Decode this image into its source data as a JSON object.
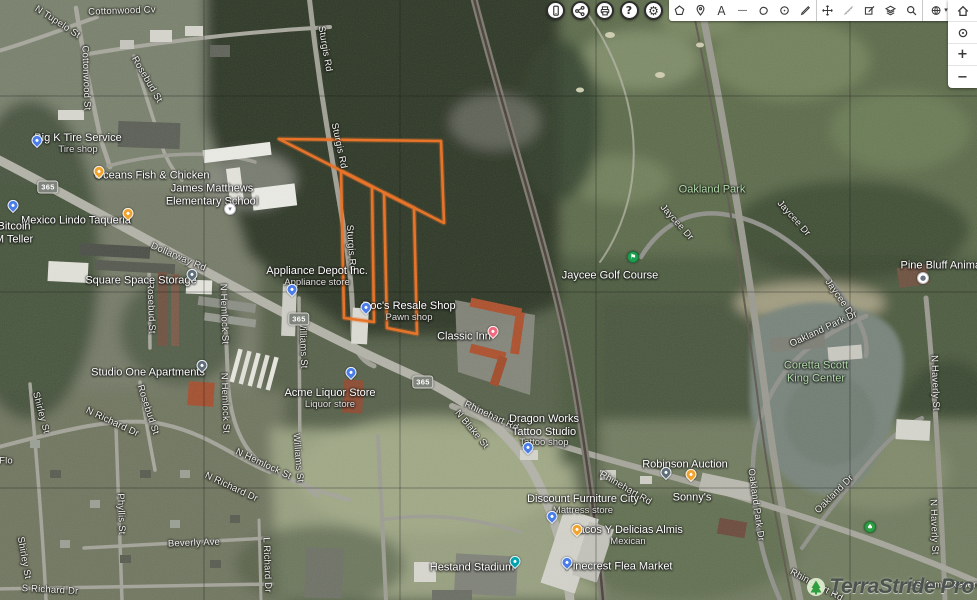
{
  "toolbar": {
    "round_buttons": [
      {
        "name": "mobile-preview"
      },
      {
        "name": "share"
      },
      {
        "name": "print"
      },
      {
        "name": "help",
        "glyph": "?"
      },
      {
        "name": "settings",
        "glyph": "⚙"
      }
    ],
    "tools": [
      {
        "name": "area-shape"
      },
      {
        "name": "add-placemark"
      },
      {
        "name": "add-text",
        "glyph": "A"
      },
      {
        "name": "draw-line",
        "glyph": "—"
      },
      {
        "name": "draw-polygon"
      },
      {
        "name": "draw-circle"
      },
      {
        "name": "draw-path"
      },
      {
        "name": "move"
      },
      {
        "name": "measure"
      },
      {
        "name": "edit-shape"
      },
      {
        "name": "layers"
      },
      {
        "name": "search"
      },
      {
        "name": "basemap",
        "caret": "▾"
      }
    ],
    "map_controls": [
      {
        "name": "home"
      },
      {
        "name": "locate"
      },
      {
        "name": "zoom-in",
        "glyph": "+"
      },
      {
        "name": "zoom-out",
        "glyph": "−"
      }
    ]
  },
  "watermark": {
    "text": "TerraStride Pro"
  },
  "map": {
    "parcel": {
      "color": "#e8742a",
      "paths": [
        "M279,139 L441,141 L444,223 Z",
        "M341,171 L344,318 L374,322 L372,187 Z",
        "M384,193 L387,328 L417,334 L414,208 Z"
      ]
    },
    "route_shields": [
      {
        "label": "365",
        "x": 48,
        "y": 187
      },
      {
        "label": "365",
        "x": 299,
        "y": 319
      },
      {
        "label": "365",
        "x": 423,
        "y": 382
      }
    ],
    "markers": [
      {
        "type": "tire-shop",
        "shape": "pin",
        "color": "#4a7de8",
        "x": 37,
        "y": 145
      },
      {
        "type": "restaurant",
        "shape": "pin",
        "color": "#f0a32e",
        "x": 99,
        "y": 176
      },
      {
        "type": "school",
        "shape": "circle",
        "color": "#ffffff",
        "glyph": "▾",
        "x": 230,
        "y": 209
      },
      {
        "type": "restaurant",
        "shape": "pin",
        "color": "#f0a32e",
        "x": 128,
        "y": 218
      },
      {
        "type": "atm",
        "shape": "pin",
        "color": "#4a7de8",
        "x": 13,
        "y": 210
      },
      {
        "type": "storage",
        "shape": "pin",
        "color": "#5f6d7a",
        "x": 192,
        "y": 279
      },
      {
        "type": "store",
        "shape": "pin",
        "color": "#4a7de8",
        "x": 292,
        "y": 294
      },
      {
        "type": "store",
        "shape": "pin",
        "color": "#4a7de8",
        "x": 366,
        "y": 312
      },
      {
        "type": "hotel",
        "shape": "pin",
        "color": "#ef6a7e",
        "x": 493,
        "y": 336
      },
      {
        "type": "apartments",
        "shape": "pin",
        "color": "#5f6d7a",
        "x": 202,
        "y": 370
      },
      {
        "type": "store",
        "shape": "pin",
        "color": "#4a7de8",
        "x": 351,
        "y": 377
      },
      {
        "type": "store",
        "shape": "pin",
        "color": "#4a7de8",
        "x": 528,
        "y": 452
      },
      {
        "type": "store",
        "shape": "pin",
        "color": "#4a7de8",
        "x": 552,
        "y": 521
      },
      {
        "type": "restaurant",
        "shape": "pin",
        "color": "#f0a32e",
        "x": 577,
        "y": 534
      },
      {
        "type": "market",
        "shape": "pin",
        "color": "#4a7de8",
        "x": 567,
        "y": 567
      },
      {
        "type": "auction",
        "shape": "pin",
        "color": "#5f6d7a",
        "x": 666,
        "y": 477
      },
      {
        "type": "restaurant",
        "shape": "pin",
        "color": "#f0a32e",
        "x": 691,
        "y": 479
      },
      {
        "type": "stadium",
        "shape": "pin",
        "color": "#00a3ad",
        "x": 515,
        "y": 566
      },
      {
        "type": "golf",
        "shape": "circle",
        "color": "#1e9e50",
        "glyph": "⚑",
        "x": 633,
        "y": 257
      },
      {
        "type": "veterinary",
        "shape": "circle",
        "color": "#ffffff",
        "glyph": "●",
        "x": 923,
        "y": 278
      },
      {
        "type": "park-tree",
        "shape": "circle",
        "color": "#2e9e44",
        "glyph": "♠",
        "x": 870,
        "y": 527
      }
    ],
    "labels": [
      {
        "t": "Cottonwood Cv",
        "x": 122,
        "y": 12,
        "r": -2,
        "k": "road"
      },
      {
        "t": "N Tupelo St",
        "x": 57,
        "y": 23,
        "r": 33,
        "k": "road"
      },
      {
        "t": "Cottonwood St",
        "x": 85,
        "y": 78,
        "r": 88,
        "k": "road"
      },
      {
        "t": "Rosebud St",
        "x": 146,
        "y": 80,
        "r": 60,
        "k": "road"
      },
      {
        "t": "Sturgis Rd",
        "x": 324,
        "y": 49,
        "r": 80,
        "k": "road"
      },
      {
        "t": "Sturgis Rd",
        "x": 338,
        "y": 146,
        "r": 78,
        "k": "road"
      },
      {
        "t": "Sturgis Rd",
        "x": 350,
        "y": 248,
        "r": 86,
        "k": "road"
      },
      {
        "t": "Dollarway Rd",
        "x": 178,
        "y": 258,
        "r": 23,
        "k": "road"
      },
      {
        "t": "Rosebud St",
        "x": 150,
        "y": 308,
        "r": 88,
        "k": "road"
      },
      {
        "t": "N Hemlock St",
        "x": 223,
        "y": 314,
        "r": 88,
        "k": "road"
      },
      {
        "t": "Williams St",
        "x": 302,
        "y": 344,
        "r": 88,
        "k": "road"
      },
      {
        "t": "N Hemlock St",
        "x": 224,
        "y": 403,
        "r": 88,
        "k": "road"
      },
      {
        "t": "Rosebud St",
        "x": 147,
        "y": 410,
        "r": 72,
        "k": "road"
      },
      {
        "t": "Shirley St",
        "x": 40,
        "y": 413,
        "r": 75,
        "k": "road"
      },
      {
        "t": "N Richard Dr",
        "x": 112,
        "y": 423,
        "r": 25,
        "k": "road"
      },
      {
        "t": "N Blake St",
        "x": 471,
        "y": 430,
        "r": 50,
        "k": "road"
      },
      {
        "t": "Rhinehart Rd",
        "x": 491,
        "y": 417,
        "r": 25,
        "k": "road"
      },
      {
        "t": "Flo",
        "x": 6,
        "y": 462,
        "r": 0,
        "k": "road"
      },
      {
        "t": "N Hemlock St",
        "x": 263,
        "y": 465,
        "r": 25,
        "k": "road"
      },
      {
        "t": "Williams St",
        "x": 297,
        "y": 458,
        "r": 85,
        "k": "road"
      },
      {
        "t": "N Richard Dr",
        "x": 231,
        "y": 488,
        "r": 25,
        "k": "road"
      },
      {
        "t": "Rhinehart Rd",
        "x": 625,
        "y": 489,
        "r": 30,
        "k": "road"
      },
      {
        "t": "Oakland Park Dr",
        "x": 755,
        "y": 505,
        "r": 82,
        "k": "road"
      },
      {
        "t": "Oakland Dr",
        "x": 835,
        "y": 495,
        "r": -45,
        "k": "road"
      },
      {
        "t": "Phyllis St",
        "x": 120,
        "y": 514,
        "r": 88,
        "k": "road"
      },
      {
        "t": "Beverly Ave",
        "x": 194,
        "y": 544,
        "r": -2,
        "k": "road"
      },
      {
        "t": "Shirley St",
        "x": 23,
        "y": 558,
        "r": 80,
        "k": "road"
      },
      {
        "t": "L Richard Dr",
        "x": 266,
        "y": 565,
        "r": 88,
        "k": "road"
      },
      {
        "t": "S Richard Dr",
        "x": 50,
        "y": 591,
        "r": 3,
        "k": "road"
      },
      {
        "t": "Rhinehart Rd",
        "x": 816,
        "y": 586,
        "r": 28,
        "k": "road"
      },
      {
        "t": "Jaycee Dr",
        "x": 676,
        "y": 223,
        "r": 48,
        "k": "road"
      },
      {
        "t": "Jaycee Dr",
        "x": 793,
        "y": 219,
        "r": 48,
        "k": "road"
      },
      {
        "t": "Jaycee Dr",
        "x": 839,
        "y": 299,
        "r": 55,
        "k": "road"
      },
      {
        "t": "Oakland Park Dr",
        "x": 824,
        "y": 330,
        "r": -25,
        "k": "road"
      },
      {
        "t": "N Haverly St",
        "x": 934,
        "y": 383,
        "r": 88,
        "k": "road"
      },
      {
        "t": "N Haverly St",
        "x": 933,
        "y": 527,
        "r": 88,
        "k": "road"
      },
      {
        "t": "US Army Reserv",
        "x": 945,
        "y": 586,
        "r": 0,
        "k": "road"
      },
      {
        "t": "Big K Tire Service",
        "s": "Tire shop",
        "x": 78,
        "y": 144,
        "k": "poi"
      },
      {
        "t": "Oceans Fish & Chicken",
        "x": 152,
        "y": 176,
        "k": "poi"
      },
      {
        "lines": [
          "James Matthews",
          "Elementary School"
        ],
        "x": 212,
        "y": 195,
        "k": "poi"
      },
      {
        "t": "Mexico Lindo Taqueria",
        "x": 76,
        "y": 221,
        "k": "poi"
      },
      {
        "lines": [
          "Bitcoin",
          "M Teller"
        ],
        "x": 14,
        "y": 233,
        "k": "poi"
      },
      {
        "t": "Square Space Storage",
        "x": 141,
        "y": 281,
        "k": "poi"
      },
      {
        "t": "Appliance Depot Inc.",
        "s": "Appliance store",
        "x": 317,
        "y": 277,
        "k": "poi"
      },
      {
        "t": "Doc's Resale Shop",
        "s": "Pawn shop",
        "x": 409,
        "y": 312,
        "k": "poi"
      },
      {
        "t": "Classic Inn",
        "x": 464,
        "y": 337,
        "k": "poi"
      },
      {
        "t": "Studio One Apartments",
        "x": 148,
        "y": 373,
        "k": "poi"
      },
      {
        "t": "Acme Liquor Store",
        "s": "Liquor store",
        "x": 330,
        "y": 399,
        "k": "poi"
      },
      {
        "lines": [
          "Dragon Works",
          "Tattoo Studio"
        ],
        "s": "Tattoo shop",
        "x": 544,
        "y": 431,
        "k": "poi"
      },
      {
        "t": "Discount Furniture City",
        "s": "Mattress store",
        "x": 583,
        "y": 505,
        "k": "poi"
      },
      {
        "t": "Tacos Y Delicias Almis",
        "s": "Mexican",
        "x": 628,
        "y": 536,
        "k": "poi"
      },
      {
        "t": "Pinecrest Flea Market",
        "x": 619,
        "y": 567,
        "k": "poi"
      },
      {
        "t": "Robinson Auction",
        "x": 685,
        "y": 465,
        "k": "poi"
      },
      {
        "t": "Sonny's",
        "x": 692,
        "y": 498,
        "k": "poi"
      },
      {
        "t": "Hestand Stadium",
        "x": 472,
        "y": 568,
        "k": "poi"
      },
      {
        "t": "Jaycee Golf Course",
        "x": 610,
        "y": 276,
        "k": "poi"
      },
      {
        "t": "Pine Bluff Animal",
        "x": 942,
        "y": 266,
        "k": "poi"
      },
      {
        "t": "Oakland Park",
        "x": 712,
        "y": 190,
        "k": "park"
      },
      {
        "lines": [
          "Coretta Scott",
          "King Center"
        ],
        "x": 816,
        "y": 372,
        "k": "park"
      }
    ]
  }
}
